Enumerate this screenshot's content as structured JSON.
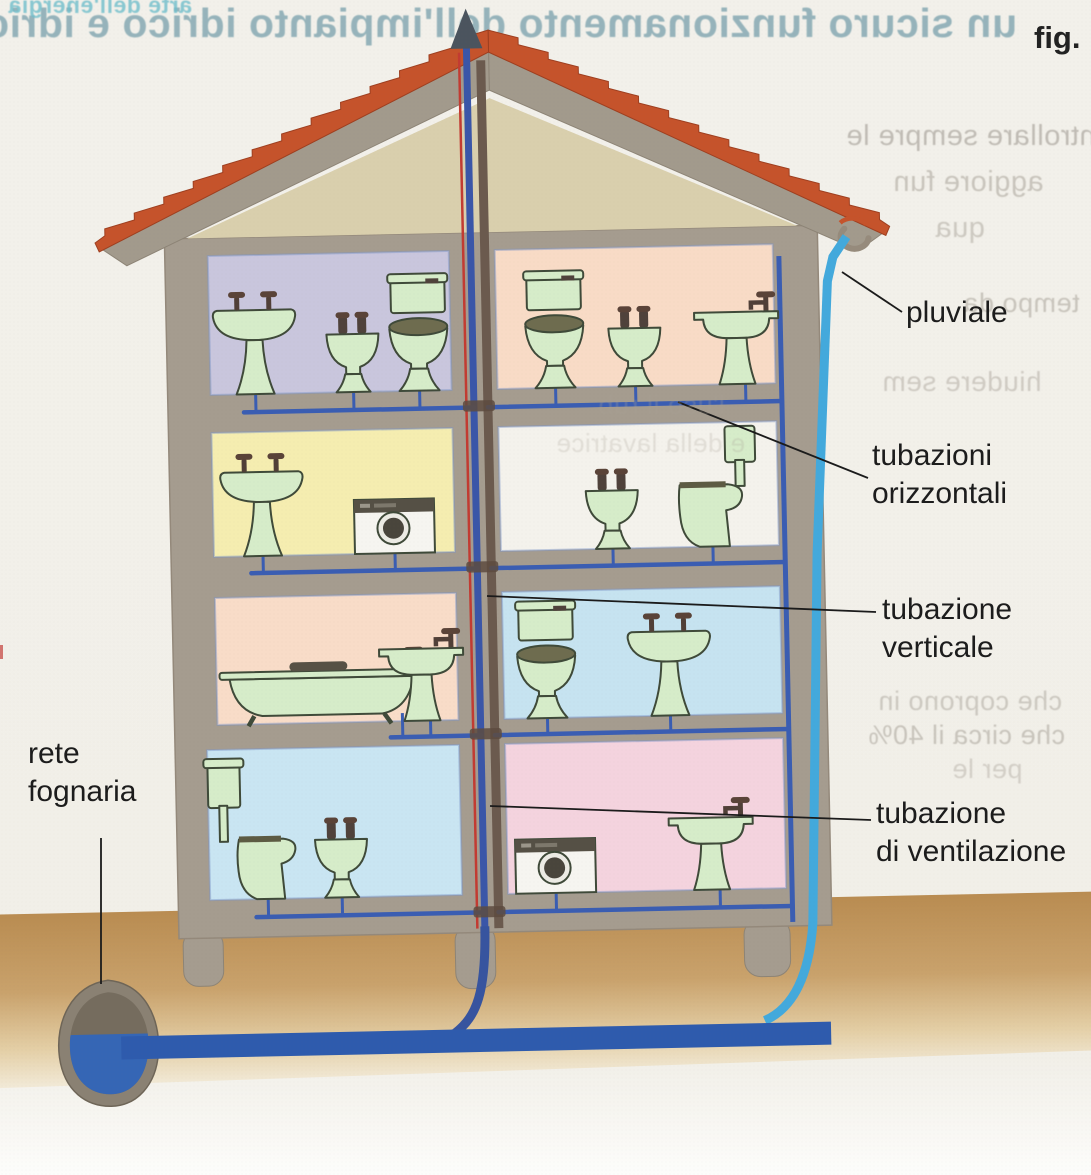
{
  "figure": {
    "fig_tag": "fig.",
    "labels": {
      "pluviale": "pluviale",
      "horizontal1": "tubazioni",
      "horizontal2": "orizzontali",
      "vertical1": "tubazione",
      "vertical2": "verticale",
      "vent1": "tubazione",
      "vent2": "di ventilazione",
      "sewer1": "rete",
      "sewer2": "fognaria"
    }
  },
  "colors": {
    "page": "#f1efe8",
    "wall": "#a59c8f",
    "wall_edge": "#8f8678",
    "roof_tile": "#c5532b",
    "roof_tile_dark": "#9e3f20",
    "gable": "#d9cfad",
    "ground": "#bb8e52",
    "water": "#3566b5",
    "sewer_pipe": "#2e5bad",
    "drain_pipe": "#3a5db2",
    "pluvial_pipe": "#43a9dc",
    "vent_pipe_brown": "#6b5a4e",
    "supply_red": "#c23b32",
    "arrow_dark": "#4b545e",
    "fixture_fill": "#d6ecc9",
    "fixture_stroke": "#3f4a39",
    "label_text": "#1c1c1c"
  },
  "building": {
    "stack_x": 478,
    "floors": [
      {
        "drain_y": 407,
        "rooms": [
          {
            "side": "left",
            "x1": 215,
            "y1": 250,
            "x2": 456,
            "y2": 389,
            "wall_color": "#c9c6dd",
            "fixtures": [
              {
                "type": "pedestal-sink",
                "x": 260
              },
              {
                "type": "bidet",
                "x": 358
              },
              {
                "type": "toilet-tank",
                "x": 424
              }
            ]
          },
          {
            "side": "right",
            "x1": 502,
            "y1": 250,
            "x2": 780,
            "y2": 389,
            "wall_color": "#f8dbc6",
            "fixtures": [
              {
                "type": "toilet-tank",
                "x": 560
              },
              {
                "type": "bidet",
                "x": 640
              },
              {
                "type": "wall-sink",
                "x": 742,
                "dir": 1
              }
            ]
          }
        ]
      },
      {
        "drain_y": 568,
        "rooms": [
          {
            "side": "left",
            "x1": 215,
            "y1": 427,
            "x2": 456,
            "y2": 551,
            "wall_color": "#f5edb0",
            "fixtures": [
              {
                "type": "pedestal-sink",
                "x": 264
              },
              {
                "type": "washing-machine",
                "x": 396
              }
            ]
          },
          {
            "side": "right",
            "x1": 502,
            "y1": 427,
            "x2": 780,
            "y2": 551,
            "wall_color": "#f4f2ec",
            "fixtures": [
              {
                "type": "bidet",
                "x": 614
              },
              {
                "type": "toilet-wall-tank",
                "x": 714
              }
            ]
          }
        ]
      },
      {
        "drain_y": 735,
        "rooms": [
          {
            "side": "left",
            "x1": 215,
            "y1": 592,
            "x2": 456,
            "y2": 719,
            "wall_color": "#f8dcc8",
            "fixtures": [
              {
                "type": "bathtub",
                "x": 320
              },
              {
                "type": "wall-sink",
                "x": 420,
                "dir": 1
              }
            ]
          },
          {
            "side": "right",
            "x1": 502,
            "y1": 592,
            "x2": 780,
            "y2": 719,
            "wall_color": "#c6e3f0",
            "fixtures": [
              {
                "type": "toilet-tank",
                "x": 545
              },
              {
                "type": "pedestal-sink",
                "x": 668
              }
            ]
          }
        ]
      },
      {
        "drain_y": 912,
        "rooms": [
          {
            "side": "left",
            "x1": 204,
            "y1": 744,
            "x2": 456,
            "y2": 894,
            "wall_color": "#c9e5f2",
            "fixtures": [
              {
                "type": "toilet-high-tank",
                "x": 262
              },
              {
                "type": "bidet",
                "x": 336
              }
            ]
          },
          {
            "side": "right",
            "x1": 502,
            "y1": 744,
            "x2": 780,
            "y2": 894,
            "wall_color": "#f4d3de",
            "fixtures": [
              {
                "type": "washing-machine",
                "x": 550
              },
              {
                "type": "wall-sink",
                "x": 706,
                "dir": 1
              }
            ]
          }
        ]
      }
    ]
  },
  "bleedthrough": [
    {
      "text": "un sicuro funzionamento dell'impianto idrico e idric",
      "x": 12,
      "y": 0,
      "width": 1005,
      "size": 41,
      "weight": 700,
      "color": "#5a8c9c",
      "opacity": 0.6
    },
    {
      "text": "arte dell'energia",
      "x": 8,
      "y": -8,
      "size": 23,
      "weight": 700,
      "color": "#6fbecb",
      "opacity": 0.8
    },
    {
      "text": "ontrollare sempre le",
      "x": 846,
      "y": 120,
      "size": 29,
      "weight": 400,
      "color": "#98928a",
      "opacity": 0.55
    },
    {
      "text": "aggiore fun",
      "x": 893,
      "y": 166,
      "size": 29,
      "weight": 400,
      "color": "#a09a90",
      "opacity": 0.5
    },
    {
      "text": "qua",
      "x": 935,
      "y": 212,
      "size": 29,
      "weight": 400,
      "color": "#a09a90",
      "opacity": 0.45
    },
    {
      "text": "tempo da",
      "x": 963,
      "y": 288,
      "size": 27,
      "weight": 400,
      "color": "#a09a90",
      "opacity": 0.5
    },
    {
      "text": "hiudere sem",
      "x": 882,
      "y": 366,
      "size": 28,
      "weight": 400,
      "color": "#a69f95",
      "opacity": 0.45
    },
    {
      "text": "l'uso il rub",
      "x": 598,
      "y": 390,
      "size": 27,
      "weight": 400,
      "color": "#a8a196",
      "opacity": 0.28,
      "over": true
    },
    {
      "text": "e della lavatrice",
      "x": 556,
      "y": 428,
      "size": 26,
      "weight": 400,
      "color": "#a8a196",
      "opacity": 0.25,
      "over": true
    },
    {
      "text": "che coprono in",
      "x": 878,
      "y": 686,
      "size": 27,
      "weight": 400,
      "color": "#a09a90",
      "opacity": 0.45
    },
    {
      "text": "che circa il 40%",
      "x": 868,
      "y": 720,
      "size": 27,
      "weight": 400,
      "color": "#a09a90",
      "opacity": 0.5
    },
    {
      "text": "per le",
      "x": 952,
      "y": 754,
      "size": 27,
      "weight": 400,
      "color": "#a69f95",
      "opacity": 0.4
    }
  ]
}
